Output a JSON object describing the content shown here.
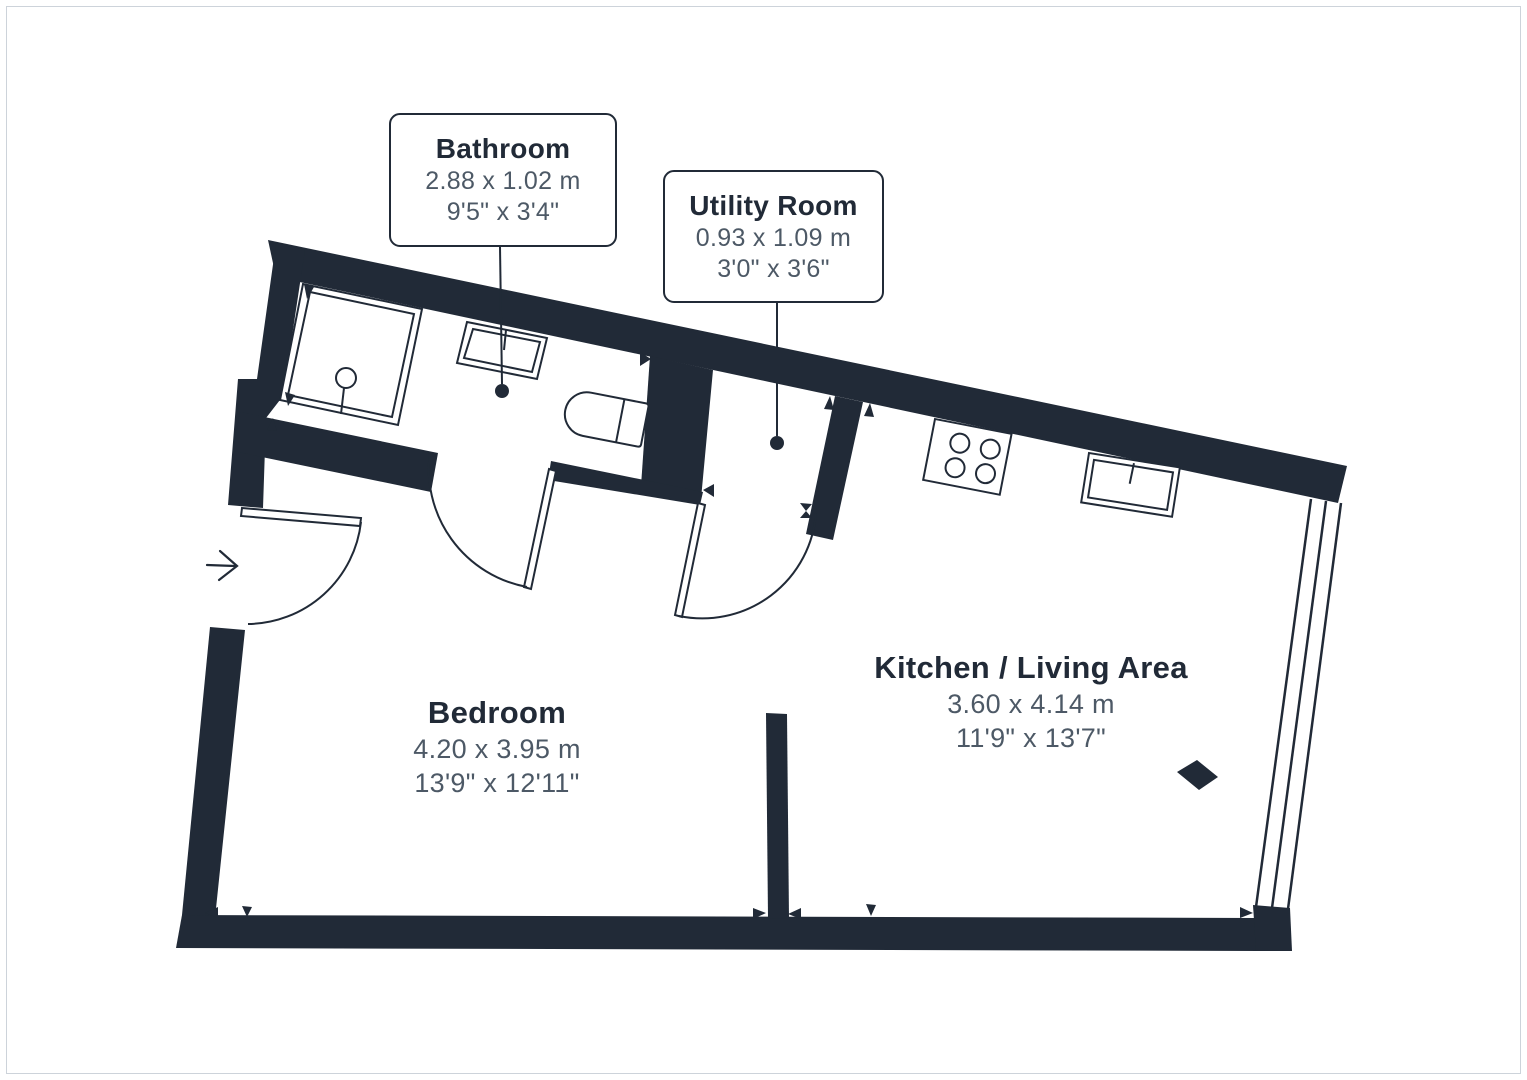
{
  "document": {
    "kind": "floor-plan",
    "background": "#ffffff"
  },
  "colors": {
    "wall": "#212A37",
    "fixture_stroke": "#212A37",
    "room_title_text": "#212A37",
    "dimension_text": "#4d5966",
    "frame_border": "#cdd3da"
  },
  "callouts": [
    {
      "id": "bathroom",
      "name": "Bathroom",
      "metric": "2.88 x 1.02 m",
      "imperial": "9'5\" x 3'4\""
    },
    {
      "id": "utility-room",
      "name": "Utility Room",
      "metric": "0.93 x 1.09 m",
      "imperial": "3'0\" x 3'6\""
    }
  ],
  "rooms": [
    {
      "id": "bedroom",
      "name": "Bedroom",
      "metric": "4.20 x 3.95 m",
      "imperial": "13'9\" x 12'11\""
    },
    {
      "id": "kitchen-living-area",
      "name": "Kitchen / Living Area",
      "metric": "3.60 x 4.14 m",
      "imperial": "11'9\" x 13'7\""
    }
  ],
  "fixtures": [
    "shower",
    "bathroom-sink",
    "toilet",
    "hob",
    "kitchen-sink",
    "entry-door",
    "bathroom-door",
    "utility-door",
    "window",
    "column",
    "entry-arrow"
  ]
}
